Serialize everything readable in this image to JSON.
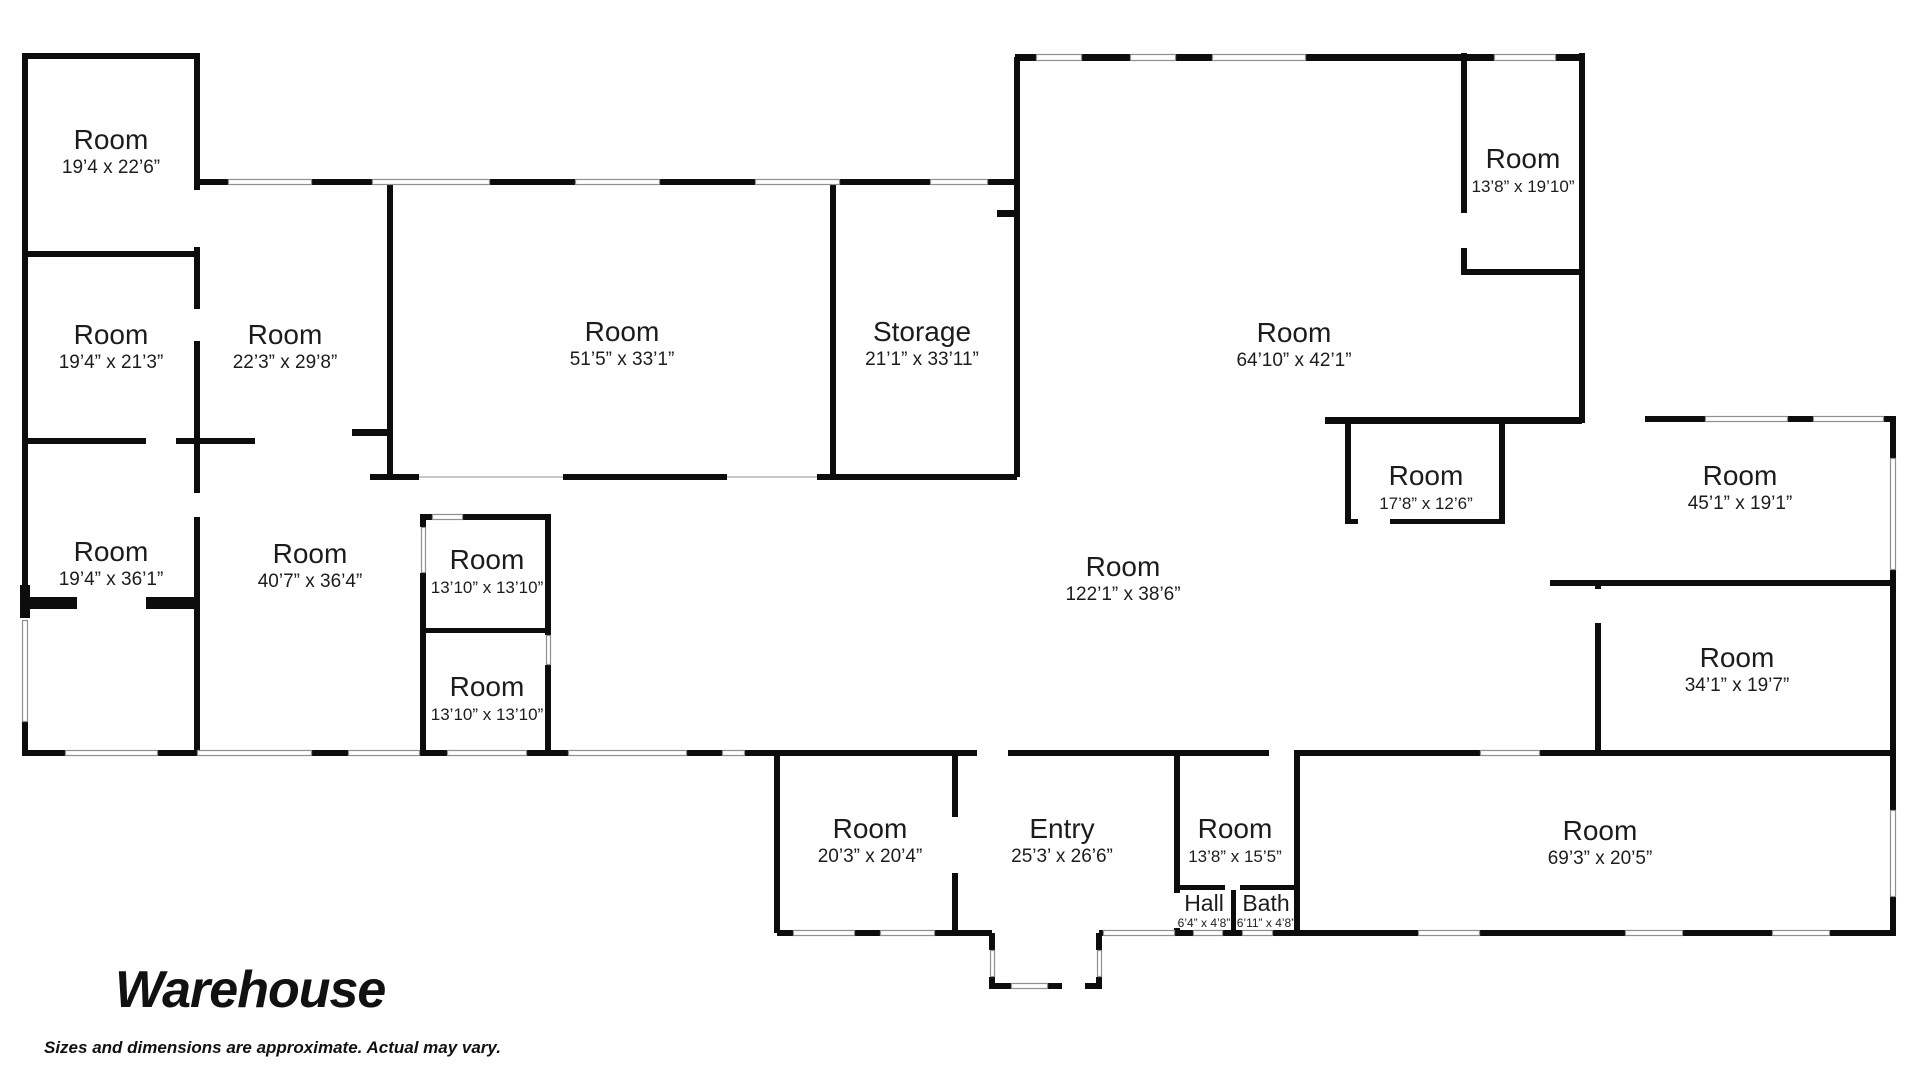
{
  "title": "Warehouse",
  "disclaimer": "Sizes and dimensions are approximate. Actual may vary.",
  "rooms": [
    {
      "name": "Room",
      "dims": "19’4 x 22’6”",
      "x": 111,
      "y": 149
    },
    {
      "name": "Room",
      "dims": "19’4” x 21’3”",
      "x": 111,
      "y": 344
    },
    {
      "name": "Room",
      "dims": "22’3” x 29’8”",
      "x": 285,
      "y": 344
    },
    {
      "name": "Room",
      "dims": "51’5” x 33’1”",
      "x": 622,
      "y": 341
    },
    {
      "name": "Storage",
      "dims": "21’1” x 33’11”",
      "x": 922,
      "y": 341
    },
    {
      "name": "Room",
      "dims": "64’10” x 42’1”",
      "x": 1294,
      "y": 342
    },
    {
      "name": "Room",
      "dims": "13’8” x 19’10”",
      "x": 1523,
      "y": 168,
      "small": true
    },
    {
      "name": "Room",
      "dims": "17’8” x 12’6”",
      "x": 1426,
      "y": 485,
      "small": true
    },
    {
      "name": "Room",
      "dims": "45’1” x 19’1”",
      "x": 1740,
      "y": 485
    },
    {
      "name": "Room",
      "dims": "19’4” x 36’1”",
      "x": 111,
      "y": 561
    },
    {
      "name": "Room",
      "dims": "40’7” x 36’4”",
      "x": 310,
      "y": 563
    },
    {
      "name": "Room",
      "dims": "13’10” x 13’10”",
      "x": 487,
      "y": 569,
      "small": true
    },
    {
      "name": "Room",
      "dims": "13’10” x 13’10”",
      "x": 487,
      "y": 696,
      "small": true
    },
    {
      "name": "Room",
      "dims": "122’1” x 38’6”",
      "x": 1123,
      "y": 576
    },
    {
      "name": "Room",
      "dims": "34’1” x 19’7”",
      "x": 1737,
      "y": 667
    },
    {
      "name": "Room",
      "dims": "20’3” x 20’4”",
      "x": 870,
      "y": 838
    },
    {
      "name": "Entry",
      "dims": "25’3’ x 26’6”",
      "x": 1062,
      "y": 838
    },
    {
      "name": "Room",
      "dims": "13’8” x 15’5”",
      "x": 1235,
      "y": 838,
      "small": true
    },
    {
      "name": "Hall",
      "dims": "6’4” x 4’8”",
      "x": 1204,
      "y": 911,
      "tiny": true
    },
    {
      "name": "Bath",
      "dims": "6’11” x 4’8”",
      "x": 1266,
      "y": 911,
      "tiny": true
    },
    {
      "name": "Room",
      "dims": "69’3” x 20’5”",
      "x": 1600,
      "y": 840
    }
  ],
  "floorplan": {
    "wall_color": "#0d0d0d",
    "window_color": "#8f8f8f",
    "walls": [
      [
        22,
        53,
        178,
        6
      ],
      [
        22,
        53,
        6,
        532
      ],
      [
        20,
        585,
        10,
        33
      ],
      [
        26,
        597,
        51,
        12
      ],
      [
        146,
        597,
        50,
        12
      ],
      [
        22,
        720,
        6,
        36
      ],
      [
        194,
        53,
        6,
        137
      ],
      [
        194,
        247,
        6,
        62
      ],
      [
        194,
        341,
        6,
        152
      ],
      [
        194,
        517,
        6,
        239
      ],
      [
        22,
        251,
        178,
        6
      ],
      [
        22,
        438,
        124,
        6
      ],
      [
        176,
        438,
        24,
        6
      ],
      [
        200,
        438,
        55,
        6
      ],
      [
        200,
        179,
        28,
        6
      ],
      [
        312,
        179,
        60,
        6
      ],
      [
        490,
        179,
        85,
        6
      ],
      [
        660,
        179,
        95,
        6
      ],
      [
        840,
        179,
        90,
        6
      ],
      [
        988,
        179,
        32,
        6
      ],
      [
        1015,
        54,
        21,
        7
      ],
      [
        1082,
        54,
        48,
        7
      ],
      [
        1176,
        54,
        36,
        7
      ],
      [
        1306,
        54,
        158,
        7
      ],
      [
        1464,
        54,
        30,
        7
      ],
      [
        1556,
        54,
        29,
        7
      ],
      [
        1014,
        57,
        6,
        420
      ],
      [
        997,
        210,
        17,
        7
      ],
      [
        830,
        182,
        6,
        295
      ],
      [
        387,
        182,
        6,
        296
      ],
      [
        352,
        429,
        38,
        7
      ],
      [
        370,
        474,
        49,
        6
      ],
      [
        563,
        474,
        164,
        6
      ],
      [
        817,
        474,
        200,
        6
      ],
      [
        420,
        514,
        131,
        6
      ],
      [
        420,
        514,
        6,
        13
      ],
      [
        420,
        573,
        6,
        60
      ],
      [
        420,
        633,
        6,
        123
      ],
      [
        545,
        514,
        6,
        121
      ],
      [
        545,
        665,
        6,
        91
      ],
      [
        420,
        628,
        131,
        5
      ],
      [
        22,
        750,
        43,
        6
      ],
      [
        158,
        750,
        39,
        6
      ],
      [
        312,
        750,
        36,
        6
      ],
      [
        420,
        750,
        27,
        6
      ],
      [
        527,
        750,
        41,
        6
      ],
      [
        687,
        750,
        35,
        6
      ],
      [
        745,
        750,
        35,
        6
      ],
      [
        777,
        750,
        200,
        6
      ],
      [
        1008,
        750,
        261,
        6
      ],
      [
        1294,
        750,
        186,
        6
      ],
      [
        1540,
        750,
        353,
        6
      ],
      [
        774,
        753,
        6,
        180
      ],
      [
        952,
        753,
        6,
        64
      ],
      [
        952,
        873,
        6,
        60
      ],
      [
        1174,
        753,
        6,
        140
      ],
      [
        1174,
        928,
        6,
        5
      ],
      [
        1294,
        753,
        6,
        180
      ],
      [
        1177,
        885,
        48,
        5
      ],
      [
        1240,
        885,
        57,
        5
      ],
      [
        1231,
        890,
        5,
        43
      ],
      [
        777,
        930,
        16,
        6
      ],
      [
        855,
        930,
        25,
        6
      ],
      [
        935,
        930,
        57,
        6
      ],
      [
        989,
        933,
        6,
        17
      ],
      [
        989,
        977,
        6,
        9
      ],
      [
        989,
        983,
        22,
        6
      ],
      [
        1048,
        983,
        14,
        6
      ],
      [
        1085,
        983,
        17,
        6
      ],
      [
        1096,
        933,
        6,
        17
      ],
      [
        1096,
        977,
        6,
        9
      ],
      [
        1099,
        930,
        6,
        6
      ],
      [
        1175,
        930,
        18,
        6
      ],
      [
        1223,
        930,
        19,
        6
      ],
      [
        1273,
        930,
        24,
        6
      ],
      [
        1297,
        930,
        121,
        6
      ],
      [
        1480,
        930,
        145,
        6
      ],
      [
        1683,
        930,
        89,
        6
      ],
      [
        1830,
        930,
        66,
        6
      ],
      [
        1890,
        416,
        6,
        42
      ],
      [
        1890,
        570,
        6,
        240
      ],
      [
        1890,
        897,
        6,
        39
      ],
      [
        1325,
        417,
        257,
        7
      ],
      [
        1579,
        53,
        6,
        370
      ],
      [
        1461,
        53,
        6,
        160
      ],
      [
        1461,
        248,
        6,
        21
      ],
      [
        1461,
        269,
        124,
        6
      ],
      [
        1345,
        424,
        6,
        100
      ],
      [
        1499,
        424,
        6,
        100
      ],
      [
        1345,
        519,
        13,
        5
      ],
      [
        1390,
        519,
        115,
        5
      ],
      [
        1645,
        416,
        60,
        6
      ],
      [
        1788,
        416,
        25,
        6
      ],
      [
        1884,
        416,
        9,
        6
      ],
      [
        1550,
        580,
        345,
        6
      ],
      [
        1595,
        583,
        6,
        6
      ],
      [
        1595,
        623,
        6,
        133
      ]
    ],
    "windows": [
      [
        228,
        179,
        84,
        6
      ],
      [
        372,
        179,
        118,
        6
      ],
      [
        575,
        179,
        85,
        6
      ],
      [
        755,
        179,
        85,
        6
      ],
      [
        930,
        179,
        58,
        6
      ],
      [
        1036,
        54,
        46,
        7
      ],
      [
        1130,
        54,
        46,
        7
      ],
      [
        1212,
        54,
        94,
        7
      ],
      [
        1494,
        54,
        62,
        7
      ],
      [
        432,
        514,
        31,
        6
      ],
      [
        65,
        750,
        93,
        6
      ],
      [
        197,
        750,
        115,
        6
      ],
      [
        348,
        750,
        72,
        6
      ],
      [
        447,
        750,
        80,
        6
      ],
      [
        568,
        750,
        119,
        6
      ],
      [
        722,
        750,
        23,
        6
      ],
      [
        1480,
        750,
        60,
        6
      ],
      [
        793,
        930,
        62,
        6
      ],
      [
        880,
        930,
        55,
        6
      ],
      [
        1011,
        983,
        37,
        6
      ],
      [
        1103,
        930,
        72,
        6
      ],
      [
        1193,
        930,
        30,
        6
      ],
      [
        1242,
        930,
        31,
        6
      ],
      [
        1418,
        930,
        62,
        6
      ],
      [
        1625,
        930,
        58,
        6
      ],
      [
        1772,
        930,
        58,
        6
      ],
      [
        1705,
        416,
        83,
        6
      ],
      [
        1813,
        416,
        71,
        6
      ],
      [
        22,
        620,
        6,
        102
      ],
      [
        421,
        527,
        5,
        46
      ],
      [
        546,
        635,
        5,
        30
      ],
      [
        1890,
        458,
        6,
        112
      ],
      [
        1890,
        810,
        6,
        87
      ],
      [
        990,
        950,
        5,
        27
      ],
      [
        1097,
        950,
        5,
        27
      ]
    ],
    "lines": [
      [
        419,
        477,
        563,
        477
      ],
      [
        727,
        477,
        817,
        477
      ]
    ]
  }
}
